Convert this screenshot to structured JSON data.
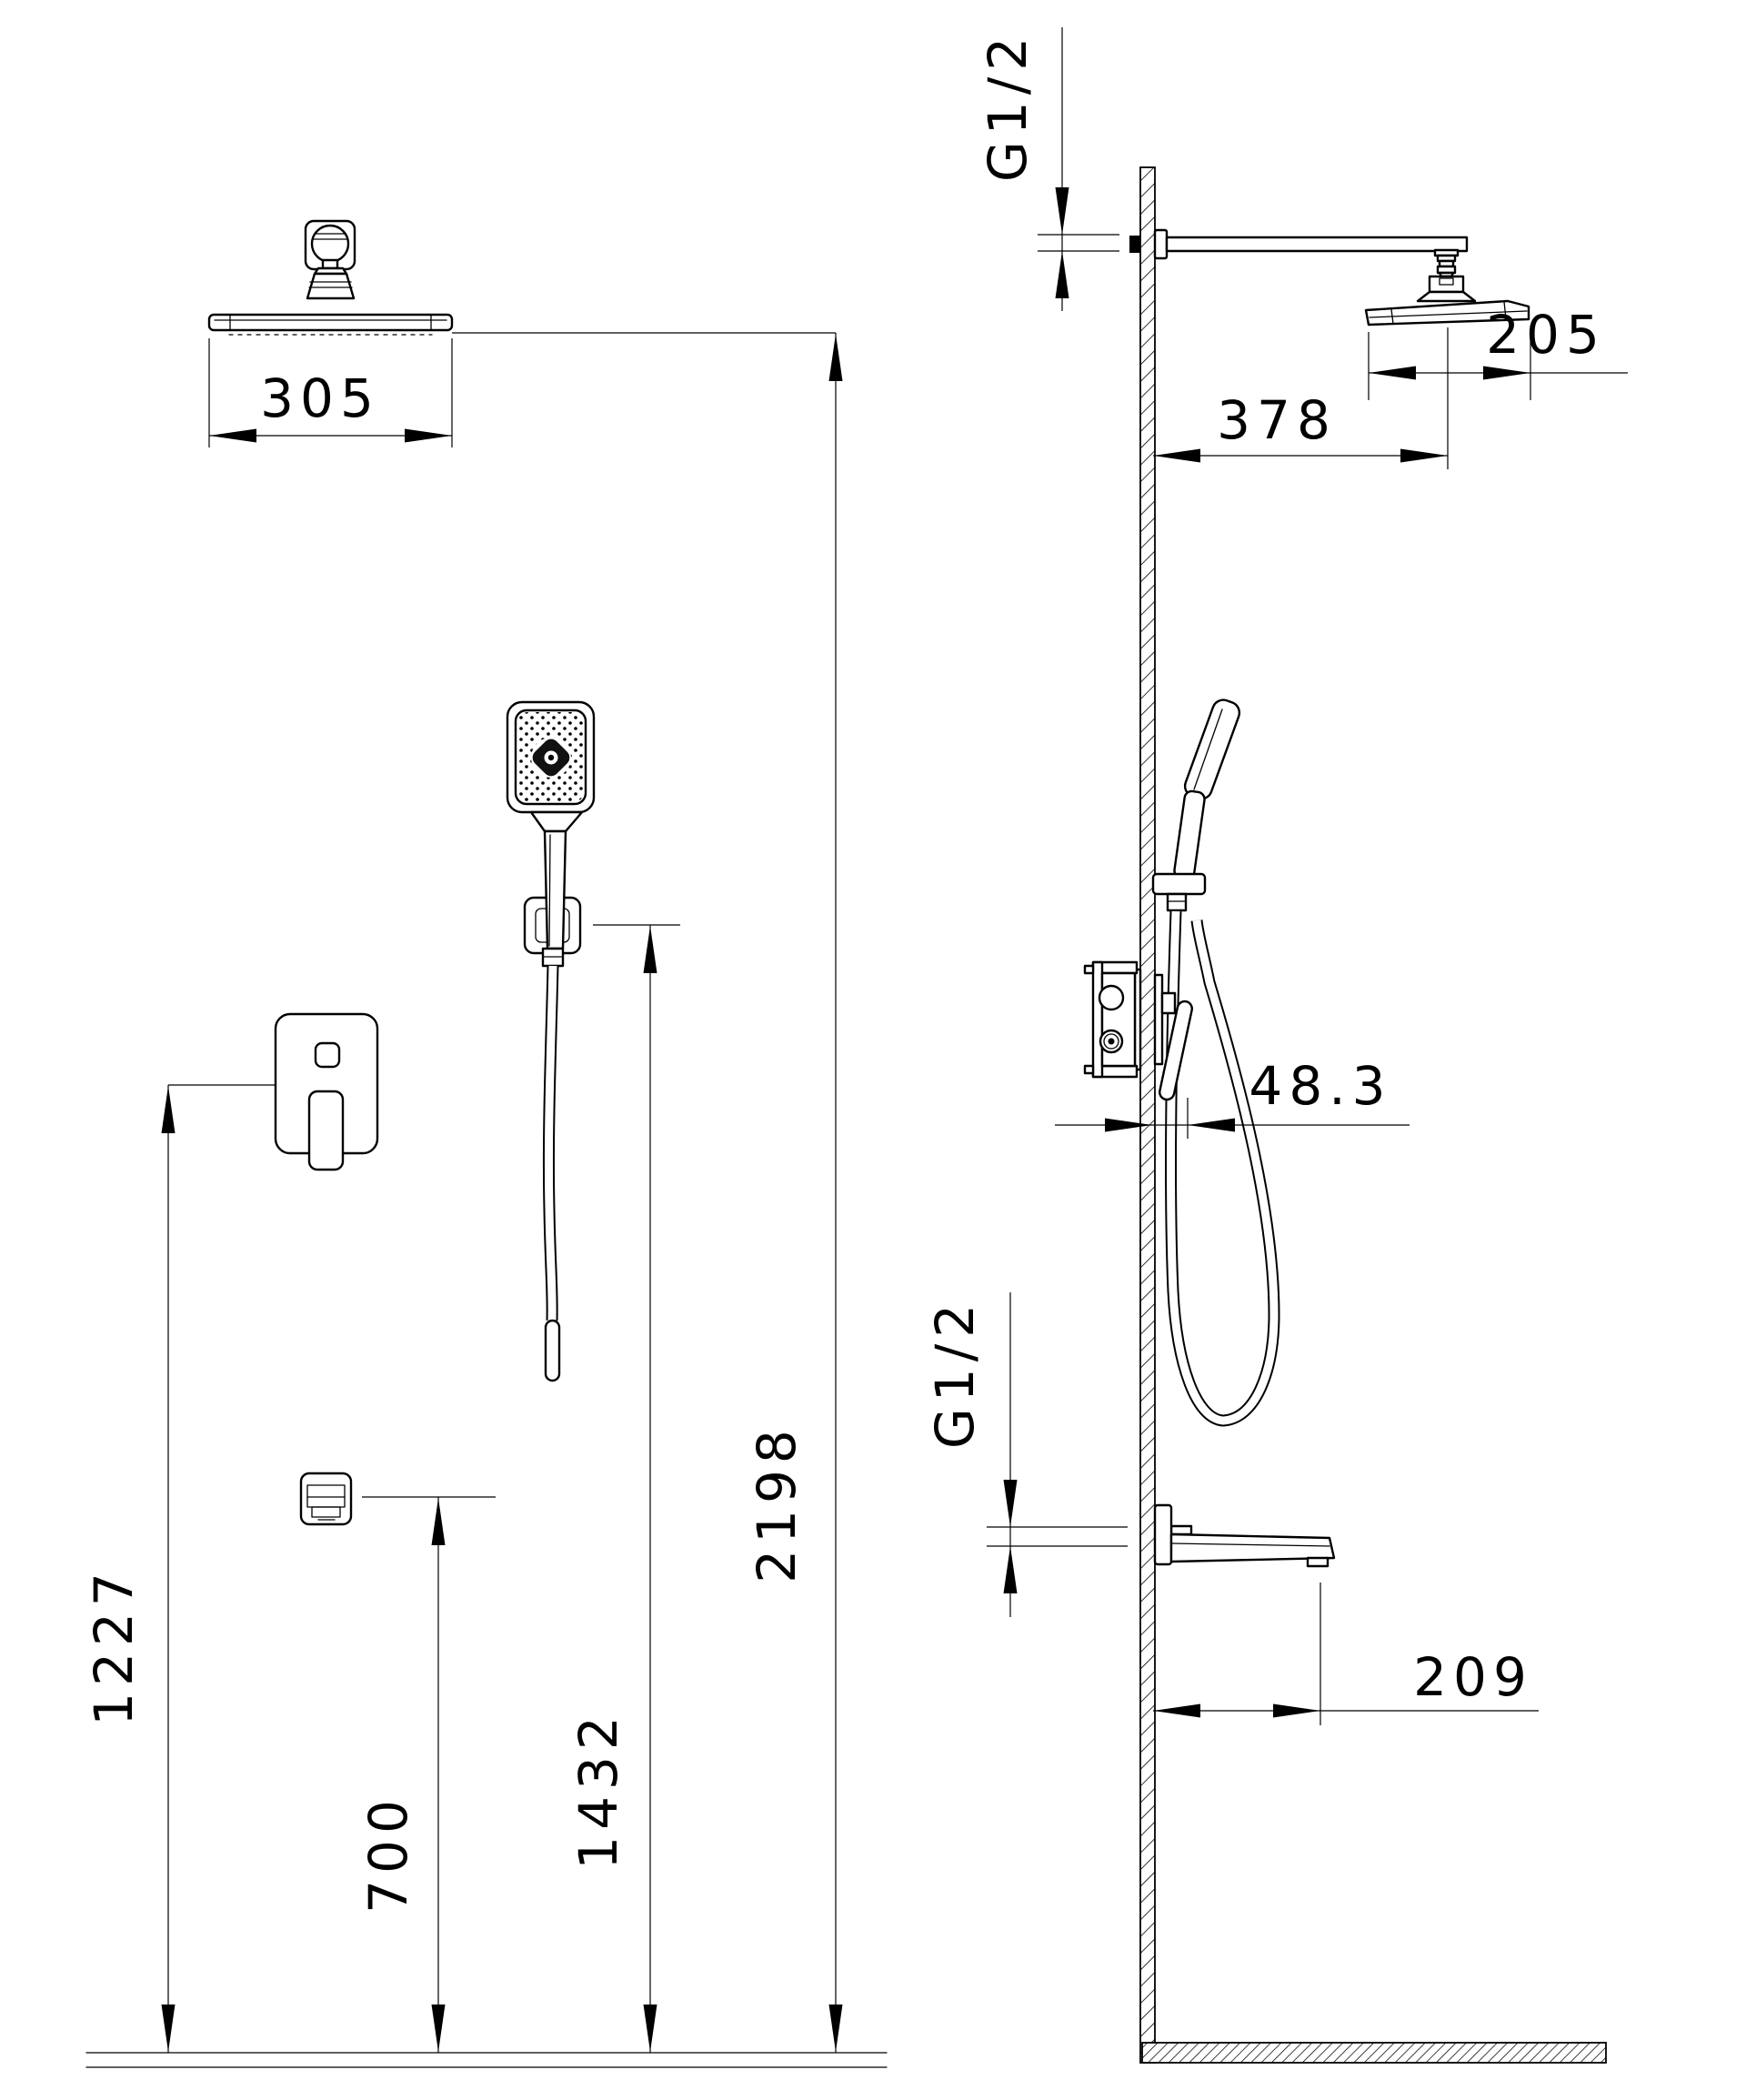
{
  "drawing": {
    "kind": "shower-system-installation-drawing",
    "background": "#ffffff",
    "line_color": "#000000",
    "views": {
      "front_view_label": "front-view",
      "side_view_label": "side-view"
    },
    "dims": {
      "front": {
        "head_width": "305",
        "mixer_height": "1227",
        "spout_height": "700",
        "hand_shower_height": "1432",
        "overall_height": "2198"
      },
      "side": {
        "arm_connection_thread": "G1/2",
        "head_depth": "205",
        "arm_reach": "378",
        "lever_projection": "48.3",
        "spout_connection_thread": "G1/2",
        "spout_reach": "209"
      }
    }
  }
}
